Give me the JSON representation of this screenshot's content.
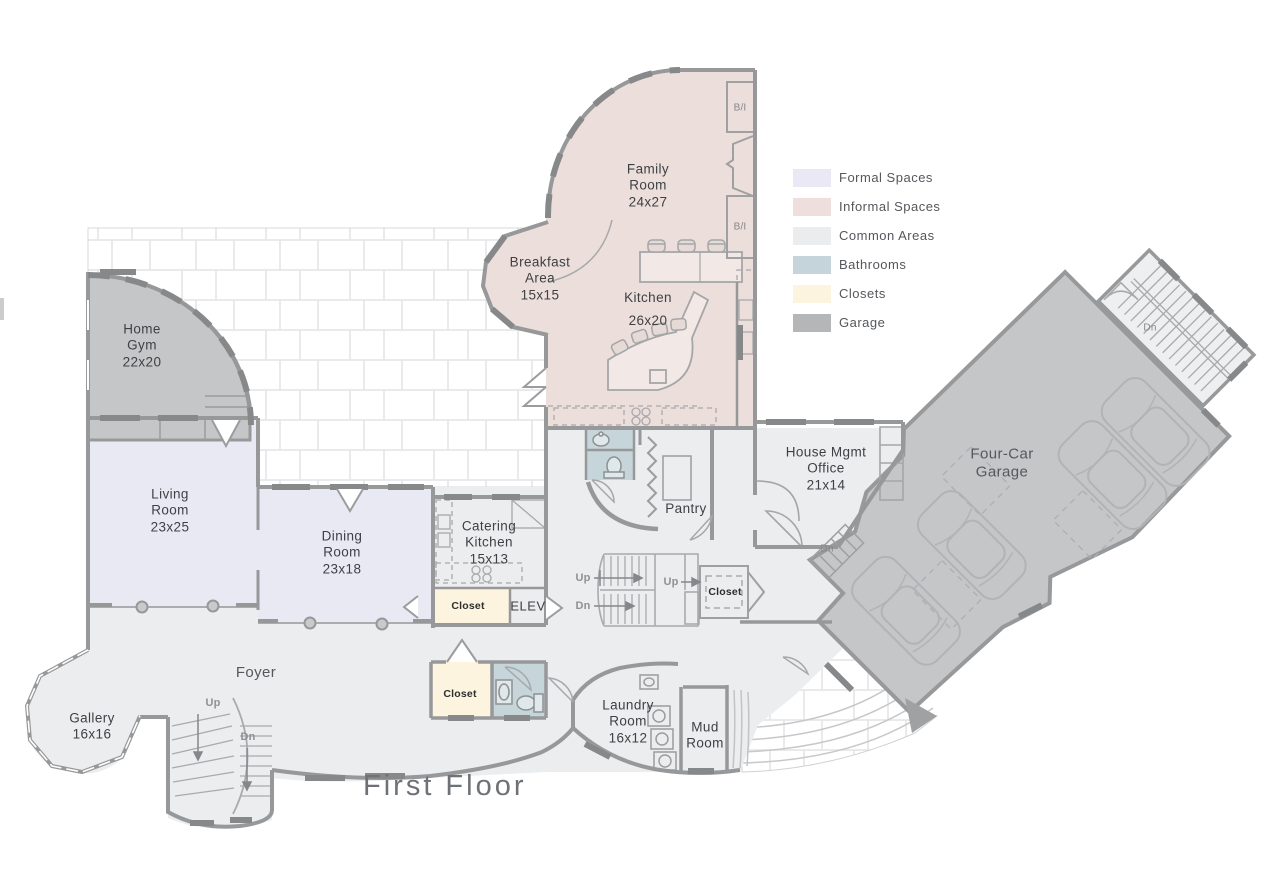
{
  "title": "First Floor",
  "legend": [
    {
      "label": "Formal Spaces",
      "color": "#e9e8f4"
    },
    {
      "label": "Informal Spaces",
      "color": "#eedfdc"
    },
    {
      "label": "Common Areas",
      "color": "#eaecee"
    },
    {
      "label": "Bathrooms",
      "color": "#c4d4da"
    },
    {
      "label": "Closets",
      "color": "#fdf4df"
    },
    {
      "label": "Garage",
      "color": "#b4b6b8"
    }
  ],
  "palette": {
    "formal": "#e9e9f4",
    "informal": "#ecdedb",
    "common": "#ebedee",
    "bathroom": "#c5d5da",
    "closet": "#fdf4df",
    "garage_room": "#c5c6c8",
    "stair_room": "#edeff0"
  },
  "rooms": {
    "family_room": {
      "name": "Family Room",
      "dims": "24x27"
    },
    "breakfast_area": {
      "name": "Breakfast Area",
      "dims": "15x15"
    },
    "kitchen": {
      "name": "Kitchen",
      "dims": "26x20"
    },
    "home_gym": {
      "name": "Home Gym",
      "dims": "22x20"
    },
    "living_room": {
      "name": "Living Room",
      "dims": "23x25"
    },
    "dining_room": {
      "name": "Dining Room",
      "dims": "23x18"
    },
    "catering_kitchen": {
      "name": "Catering Kitchen",
      "dims": "15x13"
    },
    "house_mgmt_office": {
      "name": "House Mgmt Office",
      "dims": "21x14"
    },
    "four_car_garage": {
      "name": "Four-Car Garage"
    },
    "pantry": {
      "name": "Pantry"
    },
    "foyer": {
      "name": "Foyer"
    },
    "gallery": {
      "name": "Gallery",
      "dims": "16x16"
    },
    "laundry_room": {
      "name": "Laundry Room",
      "dims": "16x12"
    },
    "mud_room": {
      "name": "Mud Room"
    }
  },
  "labels": {
    "closet": "Closet",
    "elevator": "ELEV",
    "up": "Up",
    "dn": "Dn",
    "built_in": "B/I"
  }
}
